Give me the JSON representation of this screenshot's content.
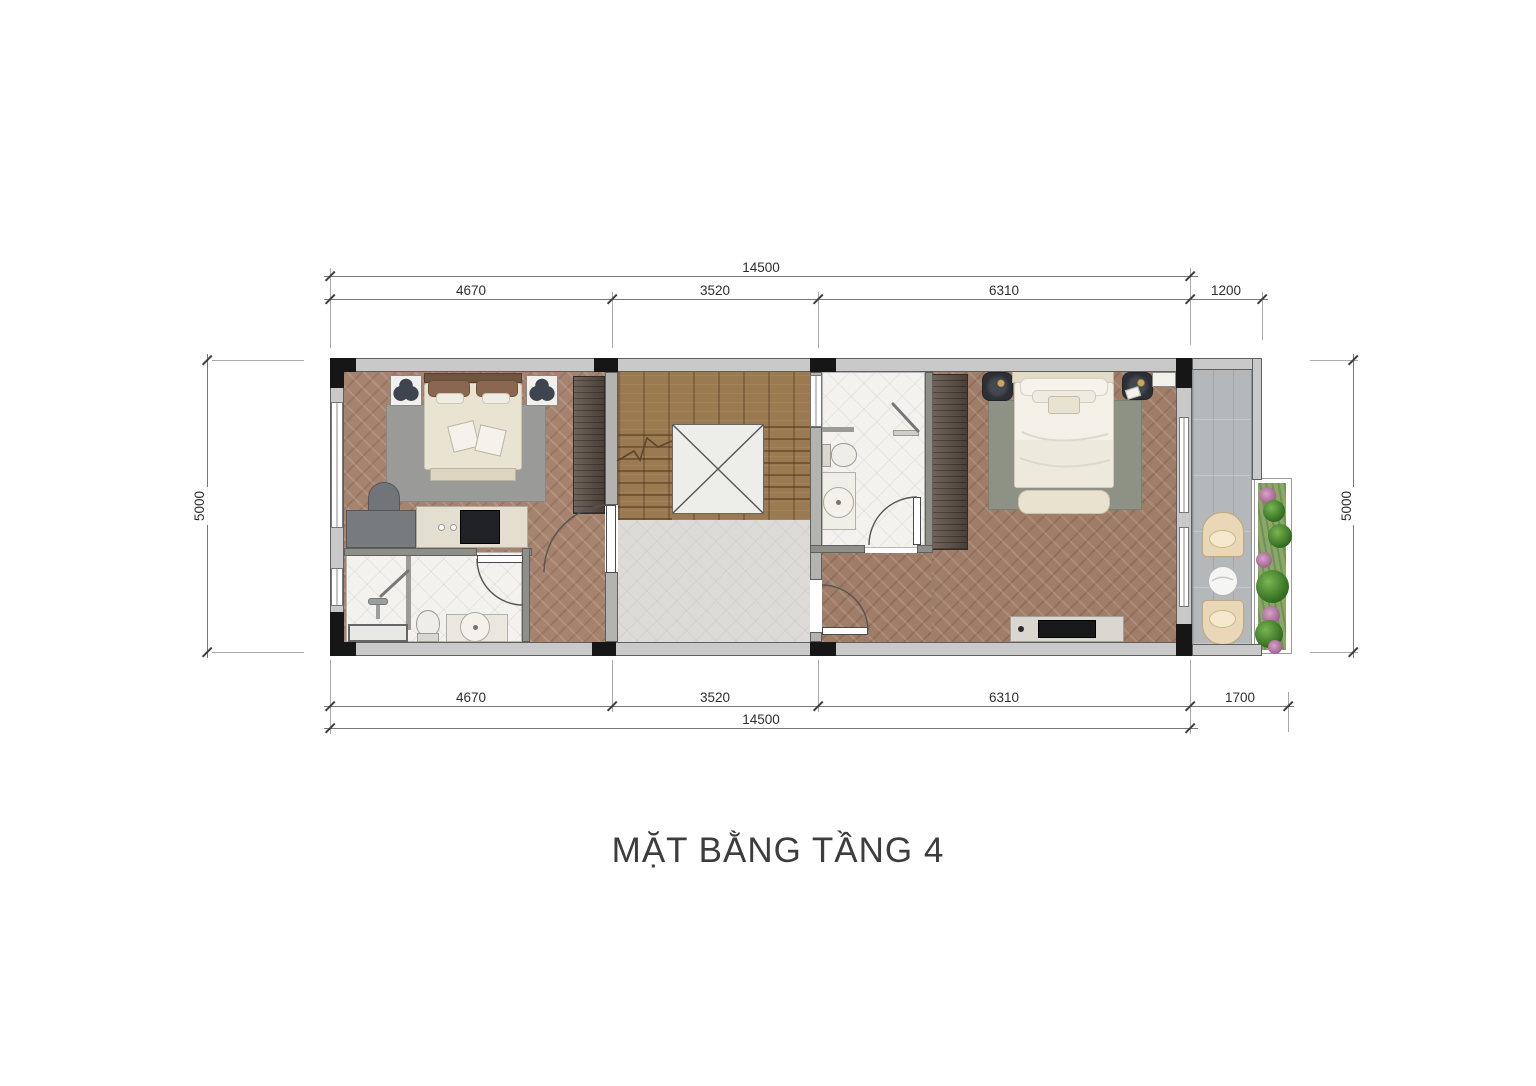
{
  "title": "MẶT BẰNG TẦNG 4",
  "dimensions": {
    "top": {
      "total": "14500",
      "segments": [
        "4670",
        "3520",
        "6310",
        "1200"
      ]
    },
    "bottom": {
      "total": "14500",
      "segments": [
        "4670",
        "3520",
        "6310",
        "1700"
      ]
    },
    "left": "5000",
    "right": "5000"
  },
  "colors": {
    "wall": "#c9c9c9",
    "column": "#161616",
    "wood": "#a6836e",
    "wood2": "#a07d68",
    "stair": "#9c7a51",
    "tile": "#f3f2ef",
    "landing": "#dcdbd7",
    "balcony": "#b5b8ba",
    "wardrobe": "#574a41",
    "dim-line": "#787878",
    "text": "#3d3d3d"
  }
}
